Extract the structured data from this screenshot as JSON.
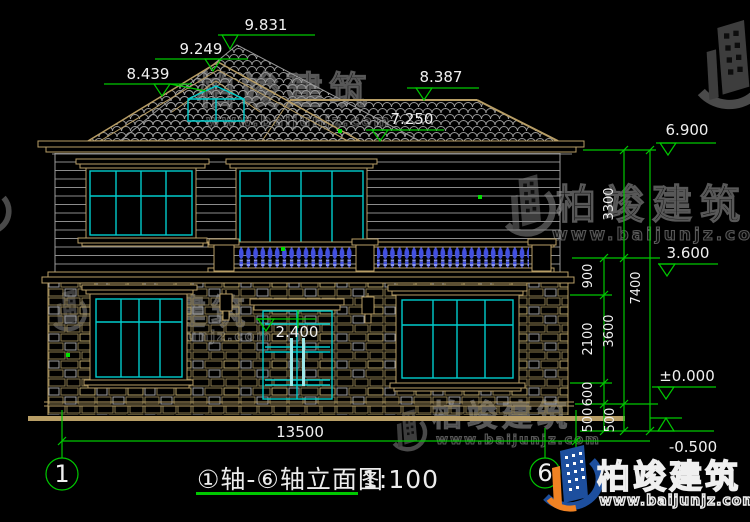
{
  "drawing": {
    "title": "①轴-⑥轴立面图",
    "scale": "1:100",
    "axis_start": "1",
    "axis_end": "6",
    "elevations": {
      "ridge": "9.831",
      "gable": "9.249",
      "left_eave": "8.439",
      "right_eave": "8.387",
      "lower_roof": "7.250",
      "second_floor_eave": "6.900",
      "balcony": "3.600",
      "door_head": "2.400",
      "ground": "±0.000",
      "site": "-0.500"
    },
    "dimensions": {
      "total_width": "13500",
      "chain_inner": [
        "900",
        "2100",
        "600",
        "500"
      ],
      "chain_mid": [
        "3300",
        "3600",
        "500"
      ],
      "chain_outer": [
        "7400"
      ]
    }
  },
  "watermark": {
    "name": "柏竣建筑",
    "url": "www.baijunjz.com"
  },
  "brand": {
    "name": "柏竣建筑",
    "url": "www.baijunjz.com"
  },
  "colors": {
    "background": "#000000",
    "trim": "#b89e66",
    "glazing": "#00cccc",
    "dimension": "#00c800",
    "text": "#f0f0f0",
    "roof_tile": "#9a9a9a",
    "baluster": "#4250e0",
    "stone": "#8a7a4e",
    "siding": "#8c8c8c",
    "watermark": "#585858",
    "logo_blue": "#1d4f9e",
    "logo_orange": "#f08223"
  }
}
